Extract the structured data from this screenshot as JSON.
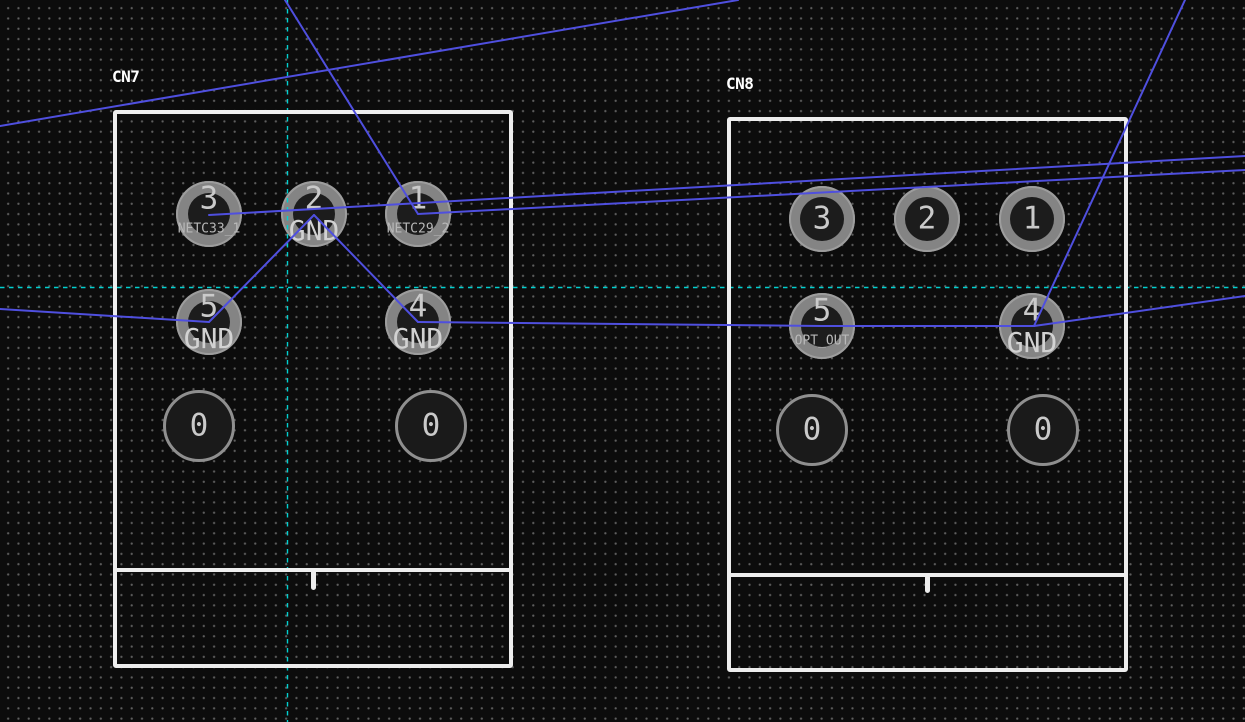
{
  "editor": {
    "width": 1245,
    "height": 722,
    "background": "#0c0c0c",
    "grid": {
      "spacing": 10.3,
      "dot_color": "#5e5e5e"
    }
  },
  "colors": {
    "track": "#4f4fdf",
    "guide": "#00d0d0",
    "silk": "#ededed",
    "pad_copper": "#848484",
    "pad_rim": "#9d9d9d",
    "pad_hole": "#1c1c1c",
    "number_text": "#cacaca",
    "net_text_small": "#b8b8b8",
    "net_text_large": "#d2d2d2",
    "reference_text": "#ffffff",
    "npth_fill": "#1a1a1a",
    "npth_ring": "#8f8f8f"
  },
  "footprints": [
    {
      "reference": "CN7",
      "label": {
        "x": 112,
        "y": 69
      },
      "outline": {
        "x": 113,
        "y": 110,
        "width": 400,
        "height": 558
      },
      "divider_y": 570,
      "notch_x": 313,
      "notch_len": 20,
      "pads": [
        {
          "number": "3",
          "net": "NETC33_1",
          "net_style": "small",
          "cx": 209,
          "cy": 214,
          "r": 33,
          "hole_r": 21,
          "style": "tht"
        },
        {
          "number": "2",
          "net": "GND",
          "net_style": "large",
          "cx": 314,
          "cy": 214,
          "r": 33,
          "hole_r": 21,
          "style": "tht"
        },
        {
          "number": "1",
          "net": "NETC29_2",
          "net_style": "small",
          "cx": 418,
          "cy": 214,
          "r": 33,
          "hole_r": 21,
          "style": "tht"
        },
        {
          "number": "5",
          "net": "GND",
          "net_style": "large",
          "cx": 209,
          "cy": 322,
          "r": 33,
          "hole_r": 21,
          "style": "tht"
        },
        {
          "number": "4",
          "net": "GND",
          "net_style": "large",
          "cx": 418,
          "cy": 322,
          "r": 33,
          "hole_r": 21,
          "style": "tht"
        },
        {
          "number": "0",
          "net": "",
          "net_style": "",
          "cx": 199,
          "cy": 426,
          "r": 36,
          "hole_r": 0,
          "style": "npth"
        },
        {
          "number": "0",
          "net": "",
          "net_style": "",
          "cx": 431,
          "cy": 426,
          "r": 36,
          "hole_r": 0,
          "style": "npth"
        }
      ]
    },
    {
      "reference": "CN8",
      "label": {
        "x": 726,
        "y": 76
      },
      "outline": {
        "x": 727,
        "y": 117,
        "width": 401,
        "height": 555
      },
      "divider_y": 575,
      "notch_x": 927,
      "notch_len": 18,
      "pads": [
        {
          "number": "3",
          "net": "",
          "net_style": "",
          "cx": 822,
          "cy": 219,
          "r": 33,
          "hole_r": 22,
          "style": "tht"
        },
        {
          "number": "2",
          "net": "",
          "net_style": "",
          "cx": 927,
          "cy": 219,
          "r": 33,
          "hole_r": 22,
          "style": "tht"
        },
        {
          "number": "1",
          "net": "",
          "net_style": "",
          "cx": 1032,
          "cy": 219,
          "r": 33,
          "hole_r": 22,
          "style": "tht"
        },
        {
          "number": "5",
          "net": "OPT_OUT",
          "net_style": "small",
          "cx": 822,
          "cy": 326,
          "r": 33,
          "hole_r": 21,
          "style": "tht"
        },
        {
          "number": "4",
          "net": "GND",
          "net_style": "large",
          "cx": 1032,
          "cy": 326,
          "r": 33,
          "hole_r": 21,
          "style": "tht"
        },
        {
          "number": "0",
          "net": "",
          "net_style": "",
          "cx": 812,
          "cy": 430,
          "r": 36,
          "hole_r": 0,
          "style": "npth"
        },
        {
          "number": "0",
          "net": "",
          "net_style": "",
          "cx": 1043,
          "cy": 430,
          "r": 36,
          "hole_r": 0,
          "style": "npth"
        }
      ]
    }
  ],
  "tracks": [
    {
      "x1": 0,
      "y1": 126,
      "x2": 738,
      "y2": 0
    },
    {
      "x1": 285,
      "y1": 0,
      "x2": 418,
      "y2": 214
    },
    {
      "x1": 209,
      "y1": 215,
      "x2": 1245,
      "y2": 156
    },
    {
      "x1": 418,
      "y1": 214,
      "x2": 1245,
      "y2": 170
    },
    {
      "x1": 314,
      "y1": 215,
      "x2": 209,
      "y2": 322
    },
    {
      "x1": 314,
      "y1": 215,
      "x2": 418,
      "y2": 322
    },
    {
      "x1": 0,
      "y1": 309,
      "x2": 209,
      "y2": 322
    },
    {
      "x1": 418,
      "y1": 322,
      "x2": 822,
      "y2": 326
    },
    {
      "x1": 822,
      "y1": 326,
      "x2": 1034,
      "y2": 326
    },
    {
      "x1": 1185,
      "y1": 0,
      "x2": 1034,
      "y2": 326
    },
    {
      "x1": 1034,
      "y1": 326,
      "x2": 1245,
      "y2": 296
    }
  ],
  "guides": {
    "vertical_x": 287,
    "horizontal_y": 287
  }
}
